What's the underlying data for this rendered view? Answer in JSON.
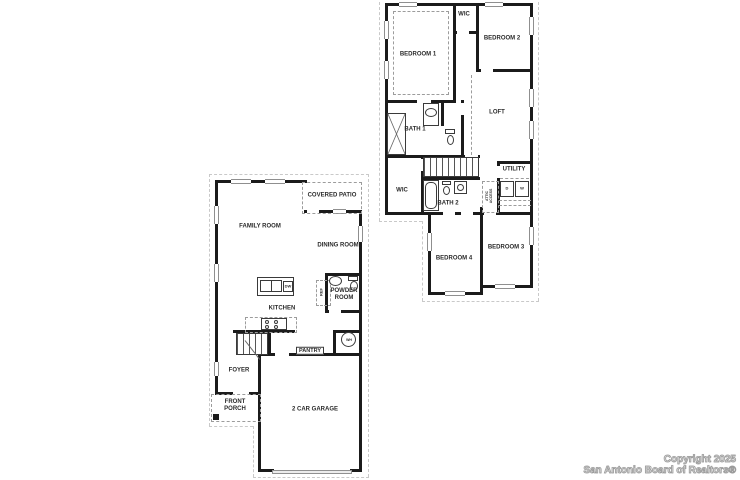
{
  "canvas": {
    "width": 740,
    "height": 480,
    "background": "#ffffff"
  },
  "watermark": {
    "line1": "Copyright 2025",
    "line2": "San Antonio Board of Realtors®"
  },
  "colors": {
    "wall": "#1b1b1b",
    "label": "#2b2b2b",
    "fixture_outline": "#3a3a3a",
    "dashed_line": "#9c9c9c",
    "roof_overhang_dash": "#c9c9c9",
    "watermark_text": "#9a9a9a",
    "background": "#ffffff"
  },
  "floors": {
    "first": {
      "labels": [
        {
          "id": "covered-patio",
          "text": "COVERED PATIO",
          "x": 117,
          "y": 16
        },
        {
          "id": "family-room",
          "text": "FAMILY ROOM",
          "x": 45,
          "y": 47
        },
        {
          "id": "dining-room",
          "text": "DINING ROOM",
          "x": 123,
          "y": 66
        },
        {
          "id": "kitchen",
          "text": "KITCHEN",
          "x": 67,
          "y": 129
        },
        {
          "id": "powder-room",
          "text": "POWDER ROOM",
          "x": 129,
          "y": 115,
          "cls": "wrap",
          "w": 32
        },
        {
          "id": "pantry",
          "text": "PANTRY",
          "x": 95,
          "y": 171,
          "cls": "box"
        },
        {
          "id": "foyer",
          "text": "FOYER",
          "x": 24,
          "y": 191
        },
        {
          "id": "front-porch",
          "text": "FRONT PORCH",
          "x": 20,
          "y": 226,
          "cls": "wrap",
          "w": 28
        },
        {
          "id": "two-car-garage",
          "text": "2 CAR GARAGE",
          "x": 100,
          "y": 230
        },
        {
          "id": "dishwasher",
          "text": "DW",
          "x": 73,
          "y": 107,
          "cls": "tiny"
        },
        {
          "id": "refrigerator",
          "text": "REF",
          "x": 107,
          "y": 112,
          "cls": "tiny rot"
        },
        {
          "id": "water-heater",
          "text": "WH",
          "x": 134,
          "y": 160,
          "cls": "mini"
        }
      ]
    },
    "second": {
      "labels": [
        {
          "id": "wic-top",
          "text": "WIC",
          "x": 79,
          "y": 12
        },
        {
          "id": "bedroom-2",
          "text": "BEDROOM 2",
          "x": 117,
          "y": 36
        },
        {
          "id": "bedroom-1",
          "text": "BEDROOM 1",
          "x": 33,
          "y": 52
        },
        {
          "id": "loft",
          "text": "LOFT",
          "x": 112,
          "y": 110
        },
        {
          "id": "bath-1",
          "text": "BATH 1",
          "x": 30,
          "y": 127
        },
        {
          "id": "wic-lower",
          "text": "WIC",
          "x": 17,
          "y": 188
        },
        {
          "id": "bath-2",
          "text": "BATH 2",
          "x": 63,
          "y": 201
        },
        {
          "id": "utility",
          "text": "UTILITY",
          "x": 129,
          "y": 167
        },
        {
          "id": "dryer",
          "text": "D",
          "x": 122,
          "y": 186,
          "cls": "tiny"
        },
        {
          "id": "washer",
          "text": "W",
          "x": 137,
          "y": 186,
          "cls": "tiny"
        },
        {
          "id": "attic-access",
          "text": "ATTIC ACCESS",
          "x": 104,
          "y": 193,
          "cls": "mini wrap rot",
          "w": 22
        },
        {
          "id": "bedroom-4",
          "text": "BEDROOM 4",
          "x": 69,
          "y": 256
        },
        {
          "id": "bedroom-3",
          "text": "BEDROOM 3",
          "x": 121,
          "y": 245
        }
      ]
    }
  }
}
